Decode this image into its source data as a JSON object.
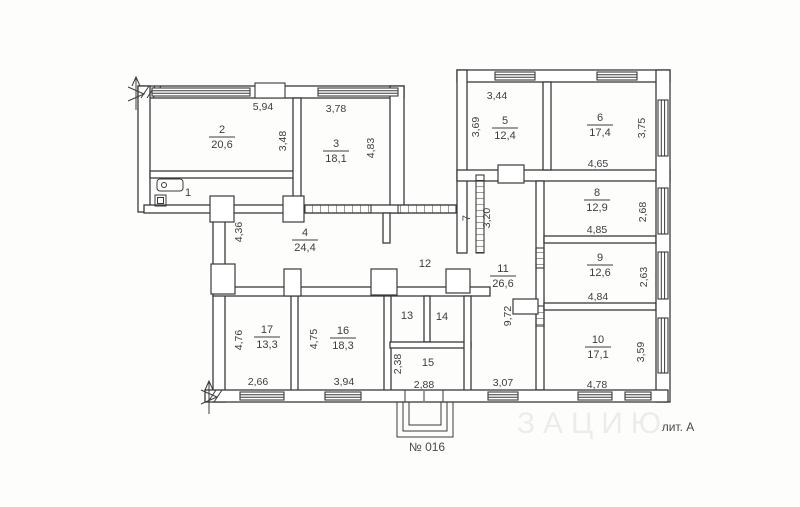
{
  "plan": {
    "plan_number": "№ 016",
    "liter": "лит. А",
    "watermark": "ЗАЦИЮ",
    "line_color": "#3a3a3a",
    "paper_color": "#fdfdfc"
  },
  "rooms": [
    {
      "number": "1",
      "area": ""
    },
    {
      "number": "2",
      "area": "20,6"
    },
    {
      "number": "3",
      "area": "18,1"
    },
    {
      "number": "4",
      "area": "24,4"
    },
    {
      "number": "5",
      "area": "12,4"
    },
    {
      "number": "6",
      "area": "17,4"
    },
    {
      "number": "7",
      "area": ""
    },
    {
      "number": "8",
      "area": "12,9"
    },
    {
      "number": "9",
      "area": "12,6"
    },
    {
      "number": "10",
      "area": "17,1"
    },
    {
      "number": "11",
      "area": "26,6"
    },
    {
      "number": "12",
      "area": ""
    },
    {
      "number": "13",
      "area": ""
    },
    {
      "number": "14",
      "area": ""
    },
    {
      "number": "15",
      "area": ""
    },
    {
      "number": "16",
      "area": "18,3"
    },
    {
      "number": "17",
      "area": "13,3"
    }
  ],
  "dimensions": {
    "room2_width": "5,94",
    "room2_height": "3,48",
    "room3_width": "3,78",
    "room3_height": "4,83",
    "room4_height": "4,36",
    "room5_width": "3,44",
    "room5_height": "3,69",
    "room6_height": "3,75",
    "room6_width": "4,65",
    "room7_length": "3,20",
    "room8_height": "2,68",
    "room8_width": "4,85",
    "room9_height": "2,63",
    "room9_width": "4,84",
    "room10_height": "3,59",
    "room10_width": "4,78",
    "corridor11_length": "9,72",
    "corridor11_width": "3,07",
    "room15_height": "2,38",
    "room15_width": "2,88",
    "room16_height": "4,75",
    "room16_width": "3,94",
    "room17_height": "4,76",
    "room17_width": "2,66"
  }
}
